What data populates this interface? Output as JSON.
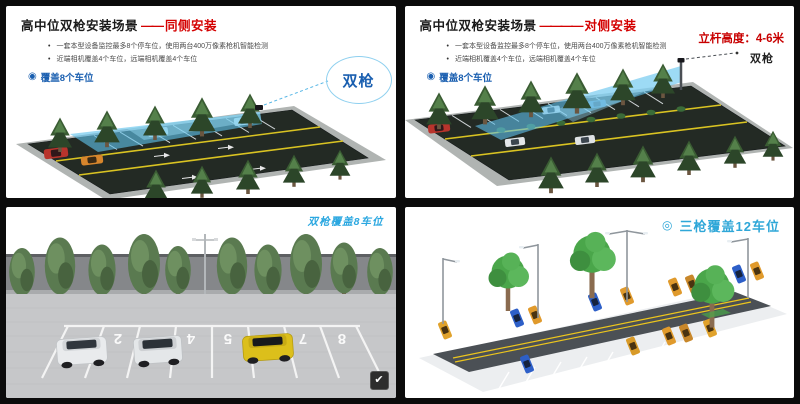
{
  "colors": {
    "accent_red": "#d40000",
    "deep_blue": "#1a5fb0",
    "caption_blue": "#2aa7e0",
    "beam_blue": "#5fc2ec"
  },
  "icons": {
    "bullet_dot": "•",
    "coverage_badge": "◉",
    "three_gun_badge": "◎",
    "check": "✔"
  },
  "panels": {
    "top_left": {
      "title": "高中位双枪安装场景",
      "title_dash": "——",
      "title_accent": "同侧安装",
      "bullets": [
        "一套本型设备监控最多8个停车位，使用两台400万像素枪机智能检测",
        "近端相机覆盖4个车位，远端相机覆盖4个车位"
      ],
      "coverage_label": "覆盖8个车位",
      "camera_label": "双枪"
    },
    "top_right": {
      "title": "高中位双枪安装场景",
      "title_dash": "————",
      "title_accent": "对侧安装",
      "pole_height": "立杆高度：4-6米",
      "bullets": [
        "一套本型设备监控最多8个停车位，使用两台400万像素枪机智能检测",
        "近端相机覆盖4个车位，远端相机覆盖4个车位"
      ],
      "coverage_label": "覆盖8个车位",
      "camera_label": "双枪"
    },
    "bottom_left": {
      "caption": "双枪覆盖8车位",
      "stall_numbers": [
        "2",
        "4",
        "5",
        "7",
        "8"
      ]
    },
    "bottom_right": {
      "caption": "三枪覆盖12车位"
    }
  }
}
